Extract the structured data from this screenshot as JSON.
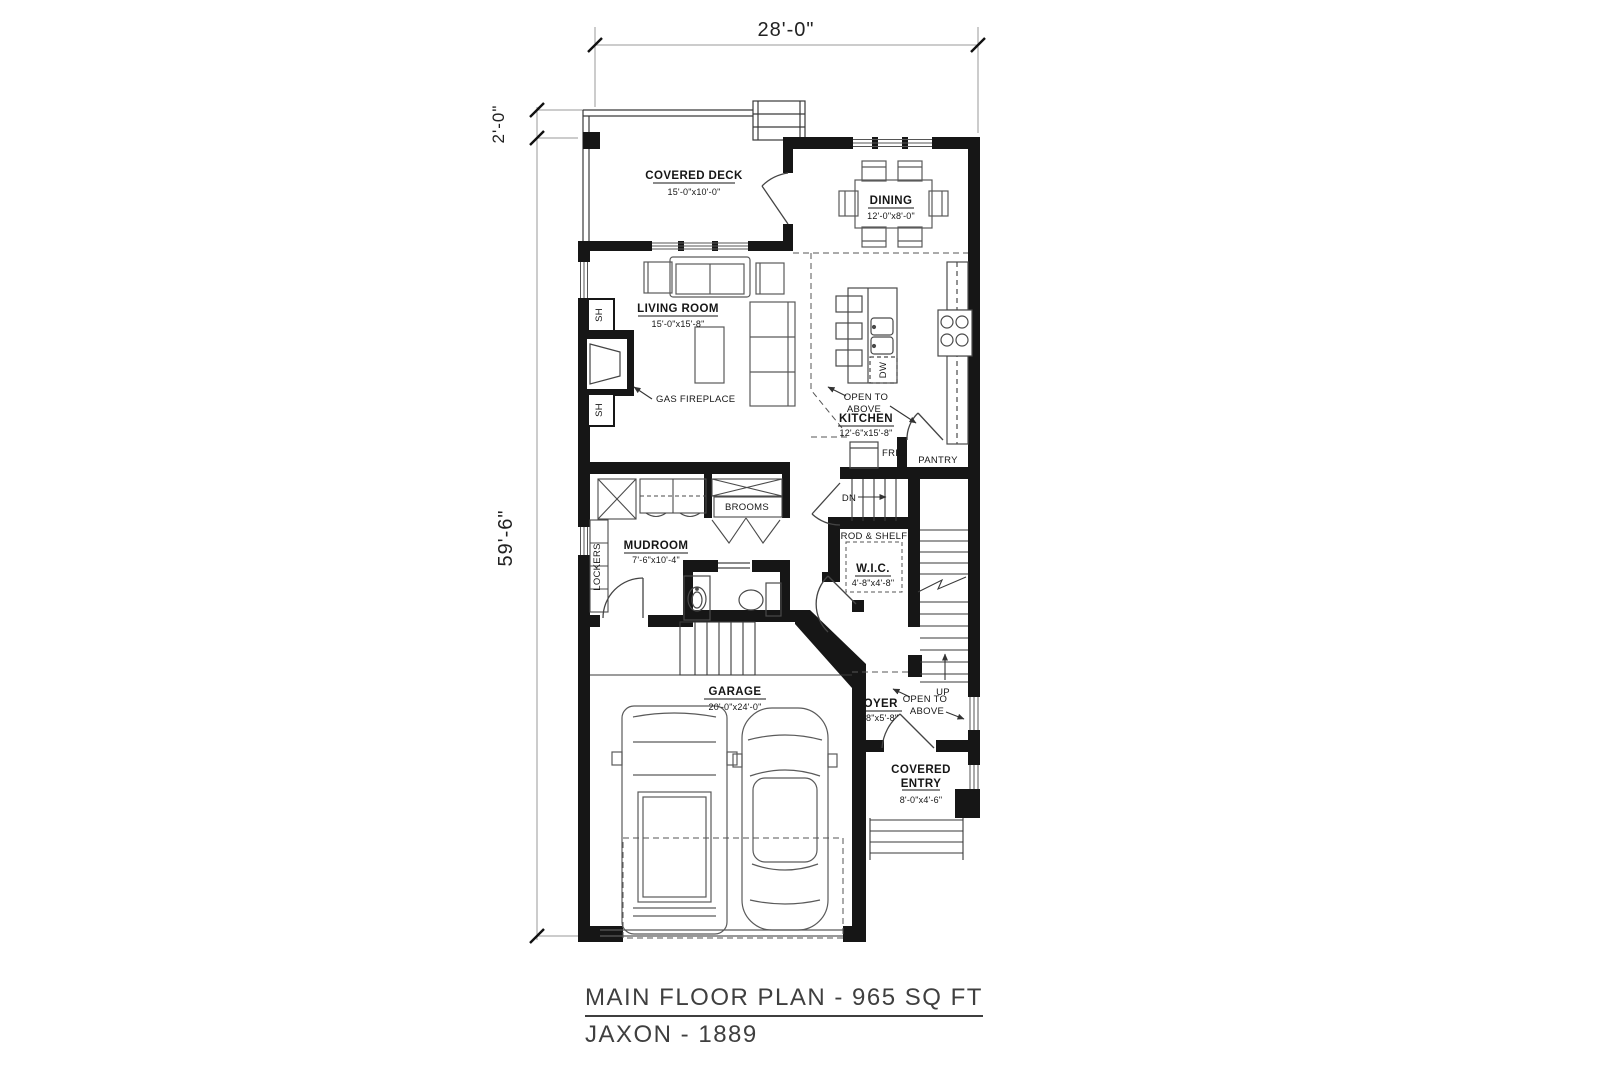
{
  "plan": {
    "dimensions": {
      "width": "28'-0\"",
      "deck_offset": "2'-0\"",
      "depth": "59'-6\""
    },
    "rooms": {
      "covered_deck": {
        "name": "COVERED DECK",
        "size": "15'-0\"x10'-0\""
      },
      "dining": {
        "name": "DINING",
        "size": "12'-0\"x8'-0\""
      },
      "living_room": {
        "name": "LIVING ROOM",
        "size": "15'-0\"x15'-8\""
      },
      "kitchen": {
        "name": "KITCHEN",
        "size": "12'-6\"x15'-8\""
      },
      "mudroom": {
        "name": "MUDROOM",
        "size": "7'-6\"x10'-4\""
      },
      "wic": {
        "name": "W.I.C.",
        "size": "4'-8\"x4'-8\""
      },
      "garage": {
        "name": "GARAGE",
        "size": "20'-0\"x24'-0\""
      },
      "foyer": {
        "name": "FOYER",
        "size": "7'-8\"x5'-8\""
      },
      "covered_entry": {
        "name_line1": "COVERED",
        "name_line2": "ENTRY",
        "size": "8'-0\"x4'-6\""
      }
    },
    "annotations": {
      "gas_fireplace": "GAS FIREPLACE",
      "open_to": "OPEN TO",
      "above": "ABOVE",
      "brooms": "BROOMS",
      "lockers": "LOCKERS",
      "shelf": "SH",
      "dishwasher": "DW",
      "fridge": "FRIG",
      "pantry": "PANTRY",
      "rod_shelf": "ROD & SHELF",
      "down": "DN",
      "up": "UP"
    },
    "title": {
      "line1": "MAIN FLOOR PLAN - 965 SQ FT",
      "line2": "JAXON - 1889"
    },
    "colors": {
      "wall": "#161616",
      "furniture_line": "#555555",
      "dimension_line": "#999999",
      "text": "#1a1a1a"
    }
  }
}
